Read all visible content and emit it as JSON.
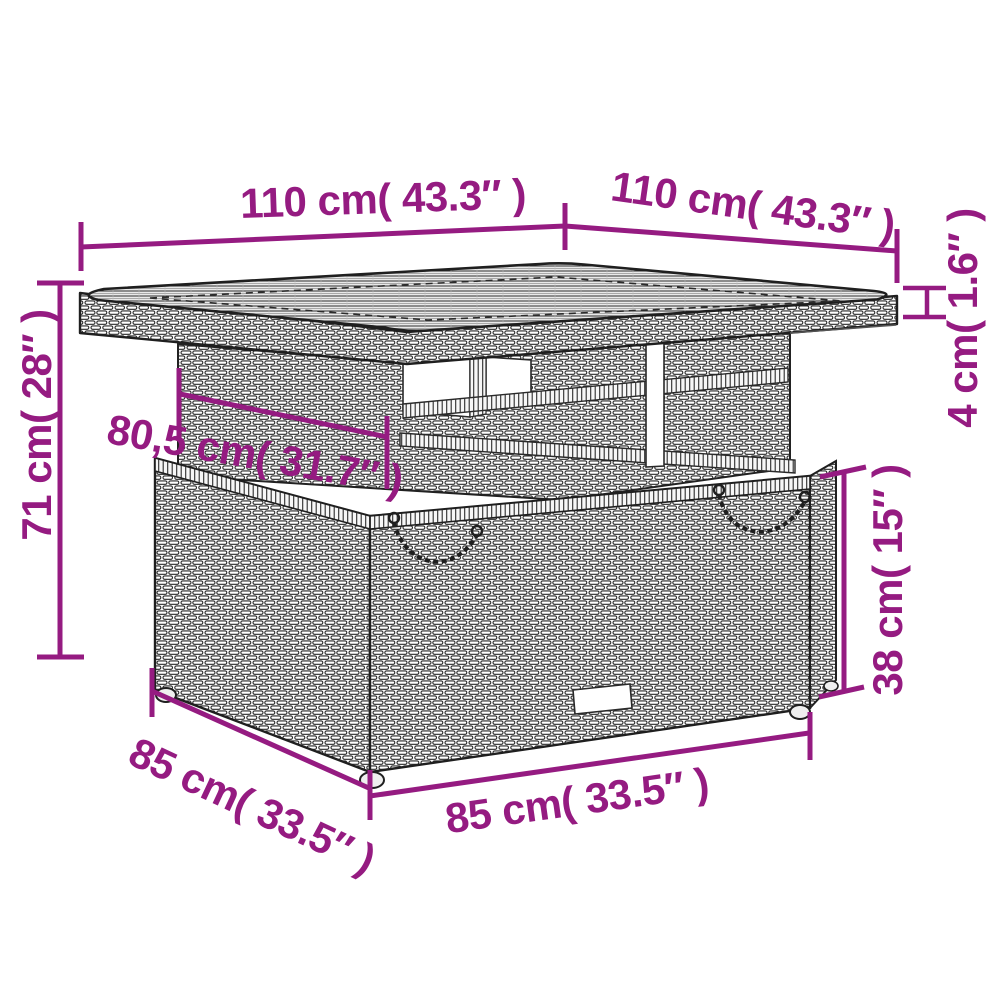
{
  "meta": {
    "type": "product-dimension-diagram",
    "subject": "poly-rattan garden table with storage base",
    "background": "#FFFFFF"
  },
  "colors": {
    "dimension_accent": "#951B81",
    "line_art": "#222222"
  },
  "dimensions": {
    "tabletop_width": {
      "label": "110 cm( 43.3″ )"
    },
    "tabletop_depth": {
      "label": "110 cm( 43.3″ )"
    },
    "tabletop_thickness": {
      "label": "4 cm( 1.6″ )"
    },
    "overall_height": {
      "label": "71 cm( 28″ )"
    },
    "apron_width": {
      "label": "80,5 cm( 31.7″ )"
    },
    "base_height": {
      "label": "38 cm( 15″ )"
    },
    "base_depth": {
      "label": "85 cm( 33.5″ )"
    },
    "base_width": {
      "label": "85 cm( 33.5″ )"
    }
  }
}
